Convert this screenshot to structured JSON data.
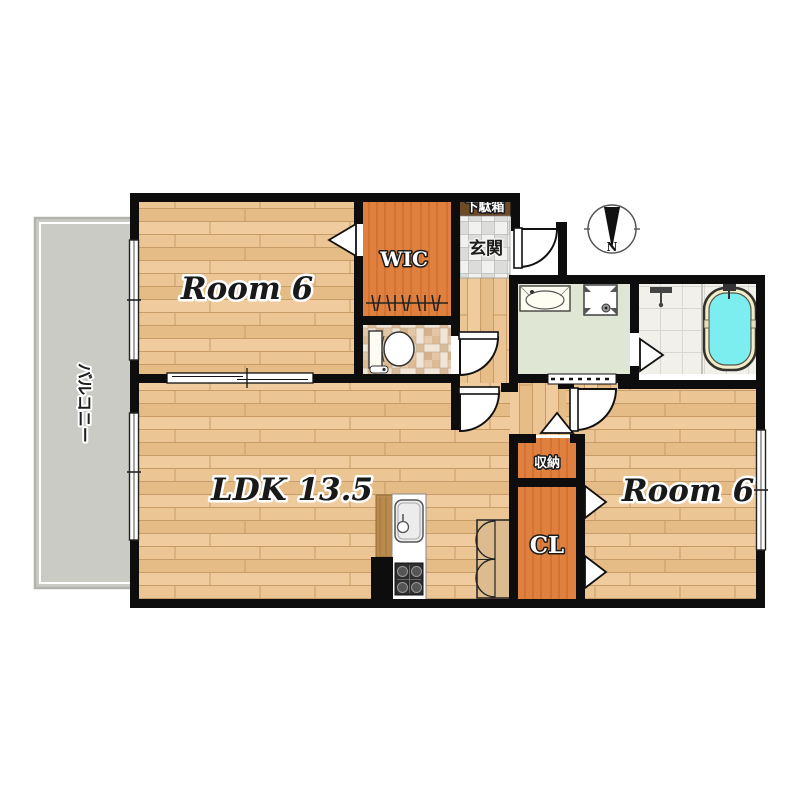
{
  "plan": {
    "labels": {
      "room_top_left": "Room 6",
      "wic": "WIC",
      "shoe_cabinet": "下駄箱",
      "entrance": "玄関",
      "ldk": "LDK 13.5",
      "storage": "収納",
      "closet": "CL",
      "room_right": "Room 6",
      "balcony": "バルコニー",
      "compass_north": "N"
    },
    "colors": {
      "wall": "#0d0d0d",
      "wood_floor": "#eac28c",
      "closet_orange": "#e0803e",
      "balcony_gray": "#cbcbc6",
      "washroom_green": "#e0e6d4",
      "bath_water_cyan": "#7deef0",
      "tub_rim_cream": "#f3ecca",
      "entrance_tile_gray": "#dddddb",
      "toilet_mosaic_beige": "#e2c6a6",
      "shoe_cabinet_brown": "#6e4a26"
    }
  }
}
